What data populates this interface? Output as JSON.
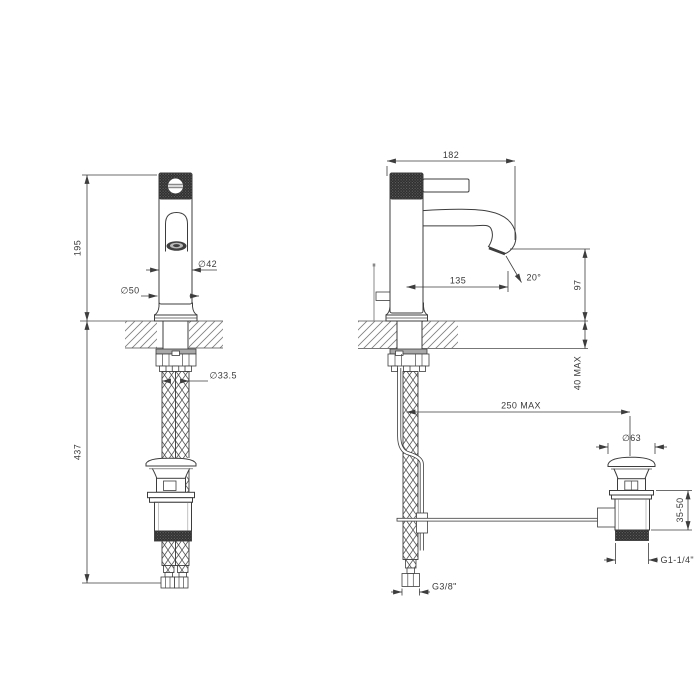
{
  "drawing": {
    "product": "Single-lever basin mixer with flexible supply hoses and pop-up waste — dimensioned technical drawing, front and side views",
    "colors": {
      "background": "#ffffff",
      "line": "#3d3d3d",
      "knurl": "#2d2d2d",
      "hardware_gray": "#a8a8a8"
    },
    "front_view": {
      "height_above_deck": "195",
      "length_below_deck": "437",
      "body_diameter": "∅42",
      "base_diameter": "∅50",
      "shank_diameter": "∅33.5"
    },
    "side_view": {
      "overall_depth": "182",
      "spout_reach": "135",
      "spout_angle": "20°",
      "spout_height": "97",
      "max_deck_thickness": "40 MAX",
      "max_waste_offset": "250 MAX",
      "waste_cap_diameter": "∅63",
      "waste_body_range": "35-50",
      "waste_thread": "G1-1/4\"",
      "hose_thread": "G3/8\""
    }
  }
}
